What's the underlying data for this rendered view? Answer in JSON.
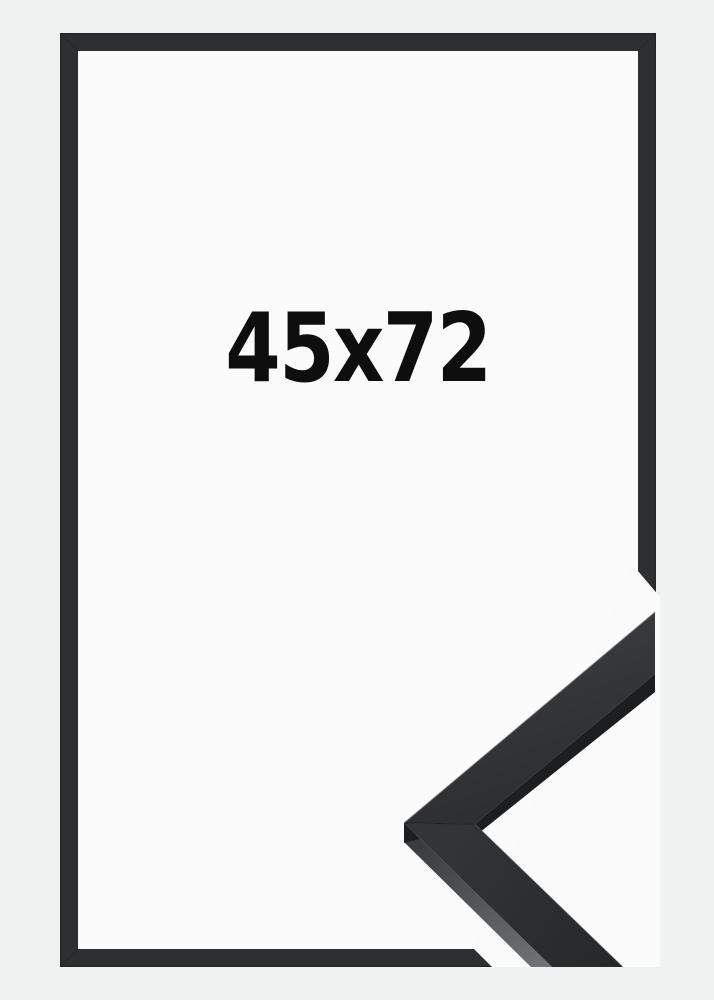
{
  "page": {
    "width_px": 714,
    "height_px": 1000,
    "background_color": "#f0f1f1"
  },
  "product_image": {
    "size_label": "45x72",
    "description": "black picture frame mockup with corner moulding sample",
    "colors": {
      "frame": "#2e2f30",
      "frame_edge": "#242526",
      "opening": "#fbfbfc",
      "label": "#0e0e0e",
      "sample_face_dark": "#2c2d2e",
      "sample_face_light": "#3a3b3c",
      "sample_side_dark": "#3a3d3f",
      "sample_side_light": "#6f7275",
      "sample_underside": "#1d1e1f",
      "sample_background": "#fafafb"
    }
  }
}
